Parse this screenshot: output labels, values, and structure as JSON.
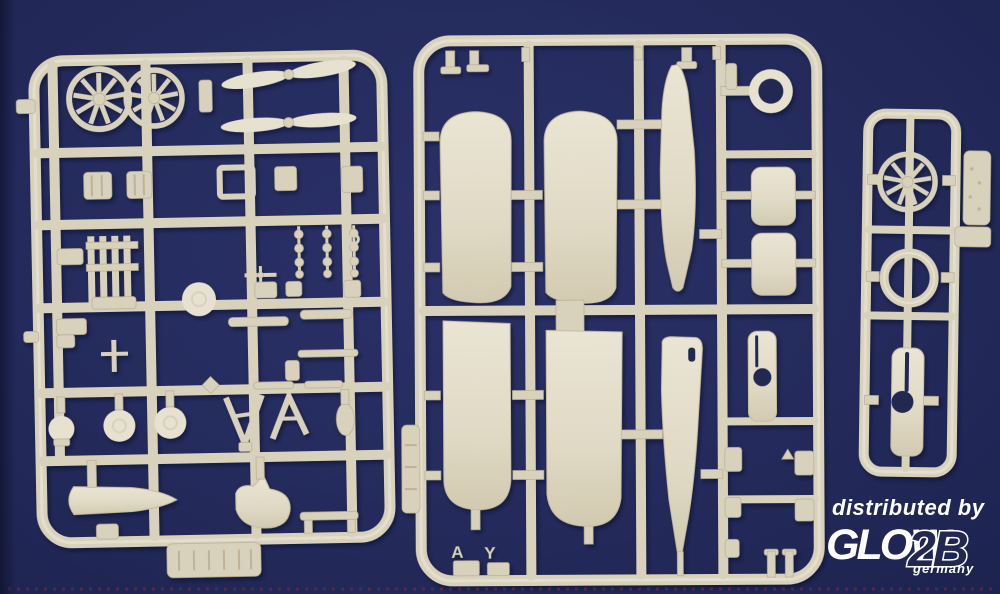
{
  "photo": {
    "background_color": "#232a5a",
    "plastic_color": "#d8d1bc"
  },
  "watermark": {
    "distributed_by": "distributed by",
    "brand": "GLOW",
    "brand_suffix": "2B",
    "country": "germany",
    "text_color": "#ffffff",
    "suffix_fill_color": "#232850"
  },
  "middle_sprue": {
    "mold_letter_a": "A",
    "mold_letter_y": "Y"
  },
  "sprues": {
    "left": {
      "parts": [
        "radial-engine",
        "radial-engine",
        "propeller",
        "propeller",
        "cylinder-block",
        "cylinder-block",
        "square-frame-part",
        "engine-bearer",
        "wheel-disc",
        "bead-chain-struts",
        "wheel",
        "wheel",
        "dome-wheel",
        "v-strut",
        "a-strut",
        "nose-cone",
        "curved-fairing",
        "bench-part",
        "name-plate"
      ]
    },
    "middle": {
      "parts": [
        "upper-wing-half",
        "upper-wing-half",
        "lower-wing-half",
        "lower-wing-half",
        "fuselage-half",
        "fuselage-half",
        "cowling-ring",
        "tail-panel",
        "tail-panel",
        "cowl-cylinder",
        "small-blocks",
        "h-pin-part",
        "side-tab"
      ]
    },
    "right": {
      "parts": [
        "radial-engine",
        "cowling-ring",
        "cowl-piece",
        "side-plate",
        "side-tab"
      ]
    }
  }
}
